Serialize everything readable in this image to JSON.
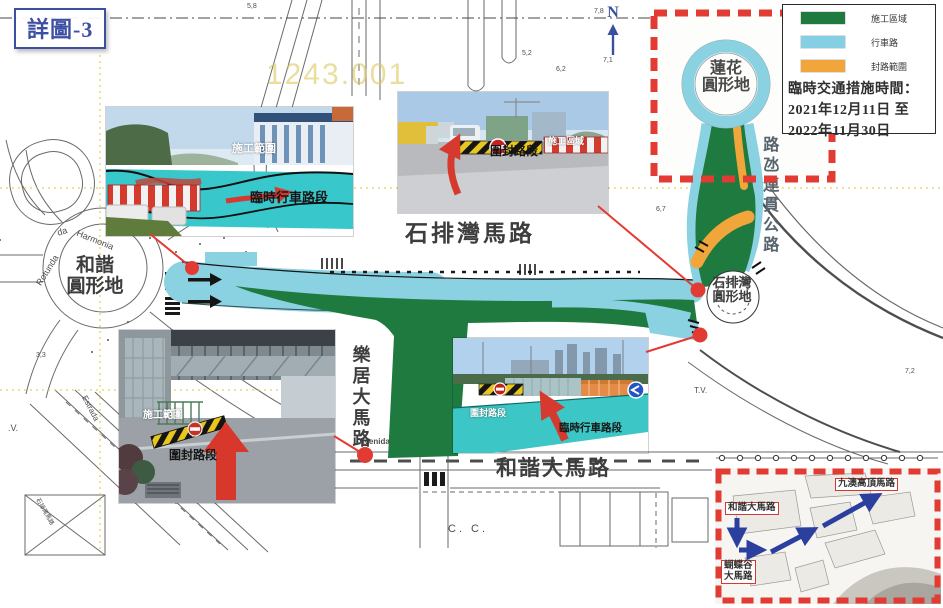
{
  "title": "詳圖-3",
  "watermark": "1243.001",
  "north": {
    "label": "N"
  },
  "colors": {
    "construction_green": "#1e7a3e",
    "carriageway_cyan": "#85cfe4",
    "closure_orange": "#f0a63a",
    "highlight_red": "#e23b33",
    "route_blue": "#2b3f9e",
    "title_blue": "#3d4fa1"
  },
  "legend": {
    "items": [
      {
        "label": "施工區域",
        "color": "#1e7a3e"
      },
      {
        "label": "行車路",
        "color": "#85cfe4"
      },
      {
        "label": "封路範圍",
        "color": "#f0a63a"
      }
    ],
    "time_heading": "臨時交通措施時間：",
    "time_from": "2021年12月11日 至",
    "time_to": "2022年11月30日"
  },
  "roads": {
    "seac_pai_van_road": "石排灣馬路",
    "harmony_avenue": "和諧大馬路",
    "lok_kui_avenue": "樂居大馬路",
    "cotai_highway": "路氹連貫公路"
  },
  "roundabouts": {
    "lotus": {
      "line1": "蓮花",
      "line2": "圓形地"
    },
    "harmony": {
      "line1": "和諧",
      "line2": "圓形地"
    },
    "seac_pai_van": {
      "line1": "石排灣",
      "line2": "圓形地"
    }
  },
  "photos": [
    {
      "label_construction": "施工範圍",
      "label_temp_lane": "臨時行車路段"
    },
    {
      "label_closed": "圍封路段",
      "label_construction": "施工區域"
    },
    {
      "label_construction": "施工範圍",
      "label_closed": "圍封路段"
    },
    {
      "label_closed": "圍封路段",
      "label_temp_lane": "臨時行車路段"
    }
  ],
  "route_inset": {
    "label_top": "九澳高頂馬路",
    "label_left": "和諧大馬路",
    "label_bottom_line1": "蝴蝶谷",
    "label_bottom_line2": "大馬路"
  },
  "annotations": [
    {
      "t": "7,8",
      "x": 594,
      "y": 8
    },
    {
      "t": "7,1",
      "x": 603,
      "y": 57
    },
    {
      "t": "5,8",
      "x": 247,
      "y": 3
    },
    {
      "t": "5,2",
      "x": 522,
      "y": 50
    },
    {
      "t": "6,2",
      "x": 556,
      "y": 66
    },
    {
      "t": "6,3",
      "x": 866,
      "y": 62
    },
    {
      "t": "6,7",
      "x": 656,
      "y": 206
    },
    {
      "t": "7,2",
      "x": 905,
      "y": 368
    },
    {
      "t": "4,3",
      "x": 540,
      "y": 370
    },
    {
      "t": "3,3",
      "x": 36,
      "y": 352
    },
    {
      "t": "T.V.",
      "x": 694,
      "y": 386,
      "s": 8
    },
    {
      "t": ".V.",
      "x": 8,
      "y": 423,
      "s": 9
    },
    {
      "t": "C. C.",
      "x": 448,
      "y": 523,
      "s": 11,
      "ls": 3
    },
    {
      "t": "Avenida",
      "x": 359,
      "y": 437,
      "s": 8,
      "b": 1
    },
    {
      "t": "Estrada",
      "x": 88,
      "y": 394,
      "r": 62,
      "s": 8
    },
    {
      "t": "Rotunda",
      "x": 34,
      "y": 282,
      "r": -58,
      "s": 9
    },
    {
      "t": "da",
      "x": 56,
      "y": 228,
      "r": -16,
      "s": 9
    },
    {
      "t": "Harmonia",
      "x": 79,
      "y": 228,
      "r": 22,
      "s": 9
    },
    {
      "t": "石排灣馬路",
      "x": 42,
      "y": 496,
      "r": 60,
      "s": 6
    }
  ]
}
